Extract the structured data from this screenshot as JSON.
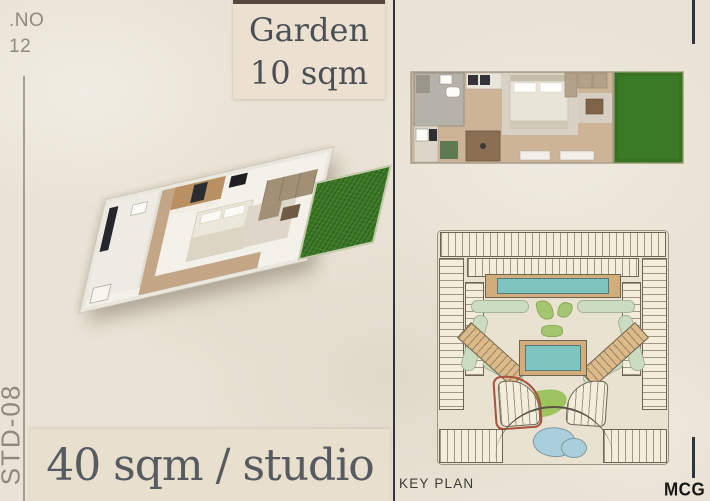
{
  "header": {
    "unit_number_label": ".NO",
    "unit_number": "12",
    "garden_label": "Garden",
    "garden_area": "10 sqm"
  },
  "left_panel": {
    "unit_type_code": "STD-08",
    "unit_area_label": "40 sqm / studio"
  },
  "right_panel": {
    "key_plan_label": "KEY PLAN"
  },
  "footer": {
    "brand": "MCG"
  },
  "colors": {
    "background": "#eae3d5",
    "garden_box": "#ece1d1",
    "area_box": "#e9dfcd",
    "title_text": "#4b5056",
    "muted_text": "#8f8a7d",
    "divider_dark": "#2f3540",
    "grass_green": "#3a7a24",
    "wood_floor": "#c3a686",
    "keyplan_pool": "#7ec5bf",
    "keyplan_deck": "#d2ad7c",
    "keyplan_mint": "#ccdcc3",
    "keyplan_lawn": "#a3c66f",
    "keyplan_pond": "#a9cfdd",
    "keyplan_highlight_red": "#a8523b"
  }
}
